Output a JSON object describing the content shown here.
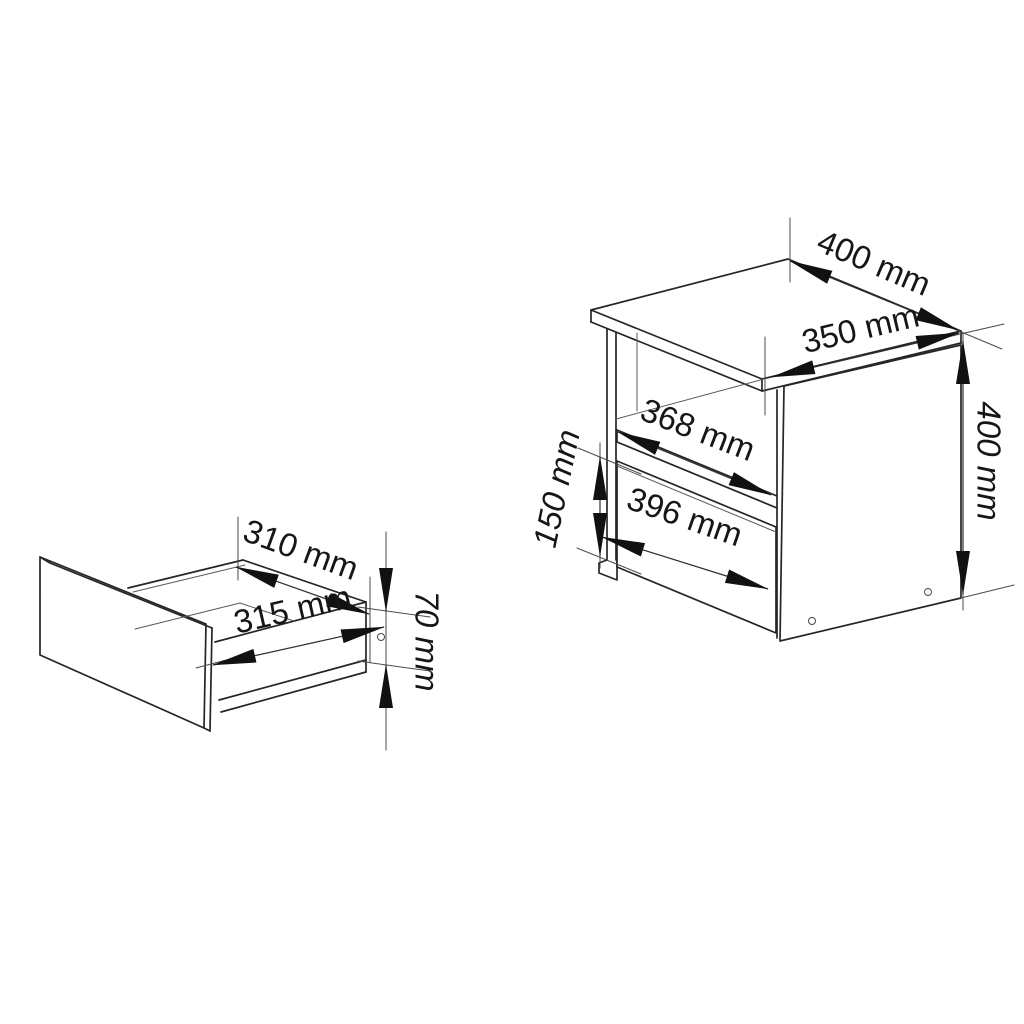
{
  "diagram": {
    "type": "furniture-dimension-drawing",
    "unit": "mm",
    "colors": {
      "background": "#ffffff",
      "line": "#262626",
      "dimension": "#2e2e2e",
      "label": "#161616"
    },
    "drawer": {
      "name": "drawer",
      "top_inner_width": "310 mm",
      "front_width": "315 mm",
      "side_height": "70 mm"
    },
    "cabinet": {
      "name": "nightstand",
      "top_width": "400 mm",
      "top_depth": "350 mm",
      "height": "400 mm",
      "shelf_opening_width": "368 mm",
      "drawer_front_width": "396 mm",
      "drawer_front_height": "150 mm"
    }
  }
}
